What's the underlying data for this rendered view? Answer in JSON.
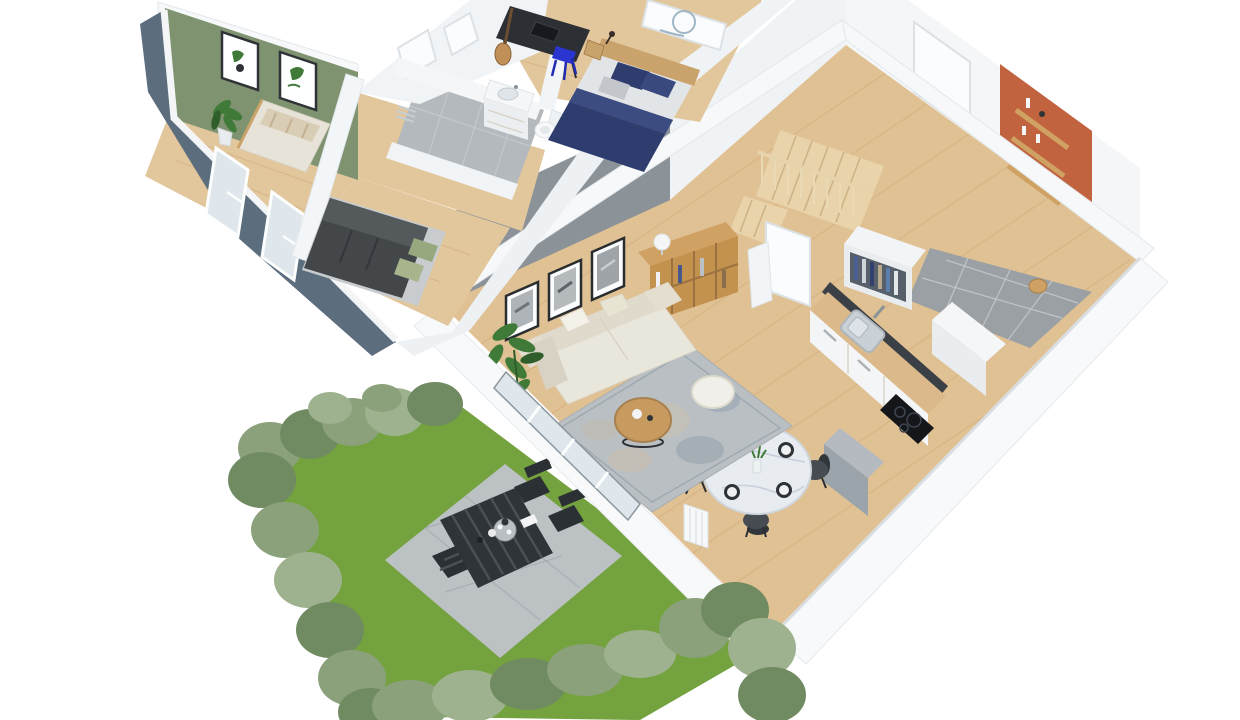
{
  "meta": {
    "description": "3D isometric cutaway floor-plan rendering of a two-storey home with garden terrace",
    "view": "isometric-cutaway-render",
    "background": "#ffffff"
  },
  "palette": {
    "upper_wall_dark": "#5c6d7e",
    "accent_green": "#7f9371",
    "accent_gray": "#8b9298",
    "accent_orange": "#c2633f",
    "wood_floor": "#e0c194",
    "wood_floor_upper": "#e3c79c",
    "counter_wood": "#dcb98a",
    "stair_wood": "#e8d3ab",
    "shelf_wood": "#cfa263",
    "coffee_table_wood": "#c79a5f",
    "headboard_wood": "#caa36c",
    "tile_gray": "#9aa0a4",
    "bath_tile": "#b3b9bd",
    "grass_green": "#74a23e",
    "hedge_green": "#8ba17c",
    "hedge_dark": "#708a62",
    "hedge_light": "#9fb28f",
    "patio_concrete": "#bcc1c3",
    "outdoor_black": "#2f3438",
    "sofa_cream": "#e9e6dc",
    "pouf_white": "#f1efe9",
    "rug_base": "#b9bfc2",
    "marble_white": "#e8ebf0",
    "chair_dark": "#474c52",
    "navy_blue": "#2e3c6e",
    "charcoal": "#43474a",
    "sage_green": "#97a87e",
    "stool_blue": "#2b35cf",
    "desk_dark": "#2c3034",
    "steel_gray": "#c9d0d6",
    "cooktop_black": "#14161a",
    "door_white": "#fbfcfd",
    "glass_blue": "#dfe7ec",
    "plant_green": "#3f7a38",
    "bed_light": "#e7e3d8",
    "fridge_gray": "#9ba3ab"
  },
  "scene": {
    "upper_floor": {
      "rooms": [
        {
          "name": "bedroom-green",
          "accent": "green-wall",
          "items": [
            "double-bed",
            "potted-plant",
            "botanical-frame",
            "botanical-frame"
          ]
        },
        {
          "name": "bedroom-charcoal",
          "items": [
            "double-bed-charcoal",
            "front-windows"
          ]
        },
        {
          "name": "bathroom",
          "items": [
            "vanity-sink",
            "toilet",
            "wall-radiator"
          ]
        },
        {
          "name": "bedroom-office",
          "items": [
            "desk",
            "blue-stool",
            "guitar",
            "single-bed-navy",
            "wall-poster",
            "nightstand"
          ]
        }
      ]
    },
    "ground_floor": {
      "rooms": [
        {
          "name": "living-room",
          "accent": "gray-wall",
          "items": [
            "sofa",
            "rug",
            "coffee-table",
            "pouf",
            "bookcase",
            "table-lamp",
            "picture-frame",
            "picture-frame",
            "picture-frame",
            "potted-plant",
            "glass-door"
          ]
        },
        {
          "name": "dining-area",
          "items": [
            "round-marble-table",
            "dining-chair",
            "dining-chair",
            "dining-chair",
            "dining-chair",
            "radiator"
          ]
        },
        {
          "name": "kitchen",
          "items": [
            "counter",
            "sink",
            "cooktop",
            "fridge",
            "corner-cabinet"
          ]
        },
        {
          "name": "hallway",
          "items": [
            "staircase",
            "understair-door",
            "wardrobe"
          ]
        },
        {
          "name": "entry",
          "accent": "orange-wall",
          "items": [
            "front-door",
            "wall-shelf",
            "wall-shelf",
            "wall-shelf",
            "tile-floor",
            "wood-stool"
          ]
        }
      ]
    },
    "garden": {
      "items": [
        "grass-lawn",
        "hedge",
        "concrete-patio",
        "outdoor-table",
        "outdoor-bench",
        "outdoor-chair",
        "outdoor-chair",
        "tray-table"
      ]
    }
  }
}
